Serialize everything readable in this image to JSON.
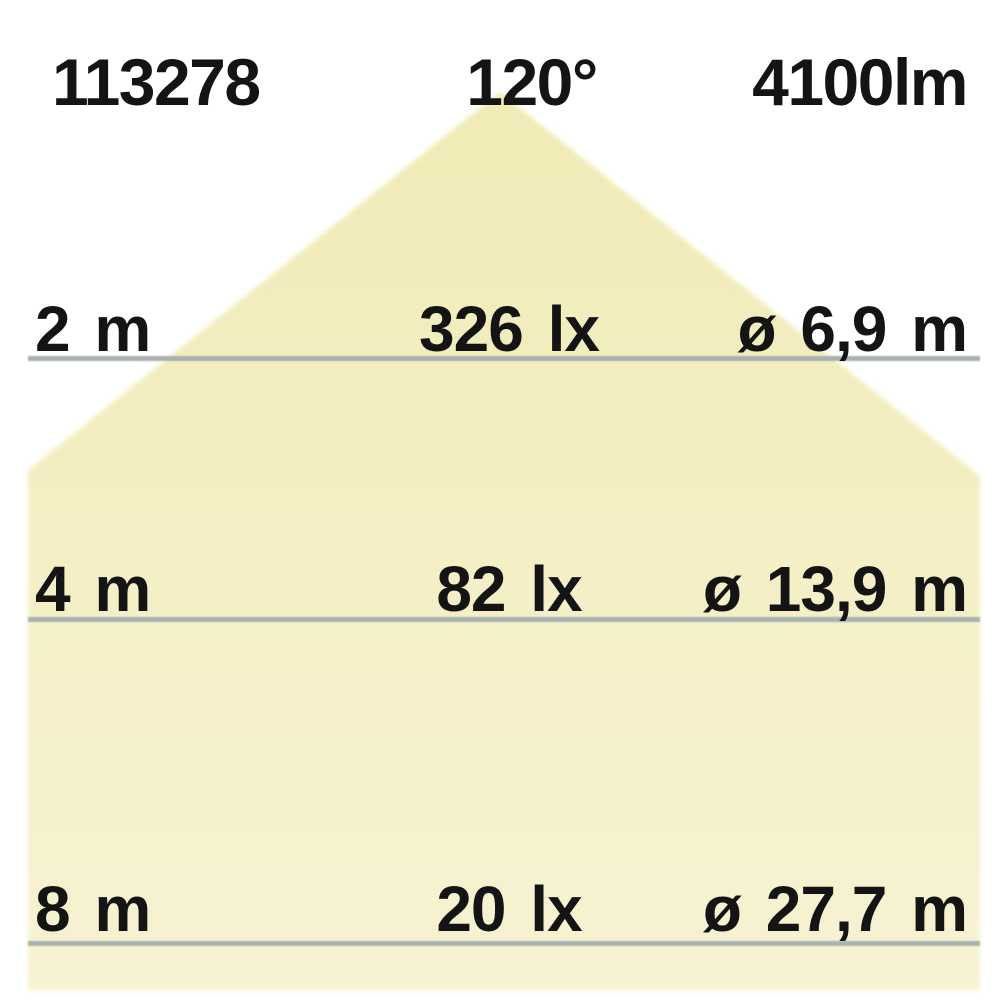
{
  "header": {
    "article_number": "113278",
    "beam_angle": "120°",
    "luminous_flux": "4100lm"
  },
  "rows": [
    {
      "distance": "2 m",
      "illuminance": "326 lx",
      "diameter": "ø 6,9 m"
    },
    {
      "distance": "4 m",
      "illuminance": "82 lx",
      "diameter": "ø 13,9 m"
    },
    {
      "distance": "8 m",
      "illuminance": "20 lx",
      "diameter": "ø 27,7 m"
    }
  ],
  "colors": {
    "cone_top": "#f1ebb6",
    "cone_bottom": "#f7f3d3",
    "line": "#a9b0b1",
    "text": "#141414",
    "background": "#ffffff"
  }
}
